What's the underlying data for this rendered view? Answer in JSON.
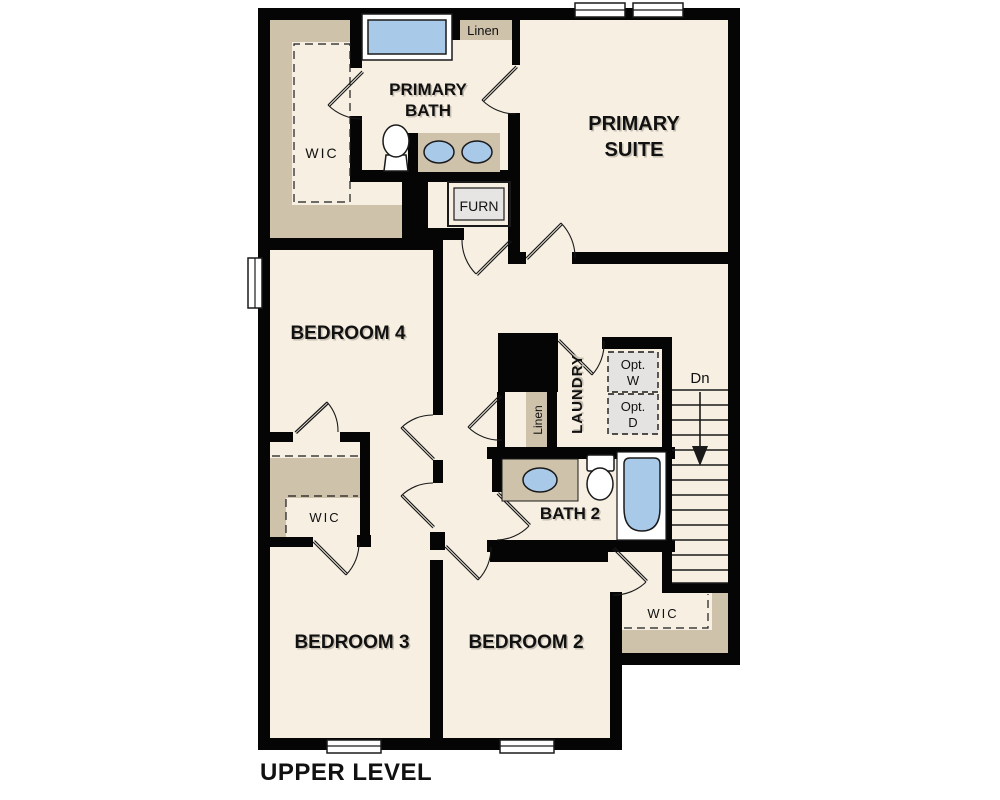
{
  "title": "UPPER LEVEL",
  "colors": {
    "wall": "#050505",
    "floor": "#f6efe2",
    "shelf": "#cfc2ab",
    "fixture_blue": "#a9c9e9",
    "appliance_gray": "#e4e3e1",
    "ink": "#111111"
  },
  "rooms": {
    "primary_suite": {
      "line1": "PRIMARY",
      "line2": "SUITE"
    },
    "primary_bath": {
      "line1": "PRIMARY",
      "line2": "BATH"
    },
    "bedroom_4": {
      "label": "BEDROOM 4"
    },
    "bedroom_3": {
      "label": "BEDROOM 3"
    },
    "bedroom_2": {
      "label": "BEDROOM 2"
    },
    "laundry": {
      "label": "LAUNDRY"
    },
    "bath_2": {
      "label": "BATH 2"
    }
  },
  "closets": {
    "primary_wic": {
      "label": "WIC"
    },
    "bedroom_3_wic": {
      "label": "WIC"
    },
    "bedroom_2_wic": {
      "label": "WIC"
    },
    "linen_upper": {
      "label": "Linen"
    },
    "linen_hall": {
      "label": "Linen"
    }
  },
  "utility": {
    "furnace": {
      "label": "FURN"
    },
    "optional_washer": {
      "line1": "Opt.",
      "line2": "W"
    },
    "optional_dryer": {
      "line1": "Opt.",
      "line2": "D"
    }
  },
  "stairs": {
    "direction_label": "Dn"
  }
}
